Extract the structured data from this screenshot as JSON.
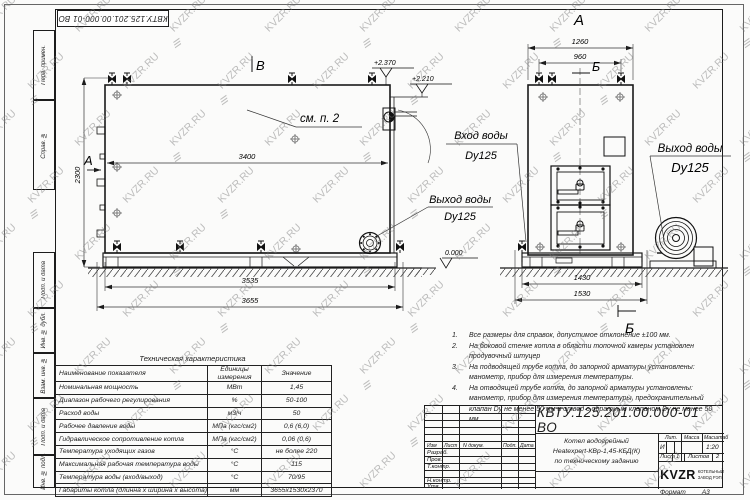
{
  "watermark": {
    "text": "KVZR.RU",
    "logo_glyph": "≡"
  },
  "stamp_top": "КВТУ.125.201.00.000-01 ВО",
  "margin_labels": [
    "Перв. примен.",
    "Справ. №",
    "Подп. и дата",
    "Инв. № дубл.",
    "Взам. инв. №",
    "Подп. и дата",
    "Инв. № подл."
  ],
  "side_view": {
    "label_top": "В",
    "label_left": "А",
    "see_note": "см. п. 2",
    "dim_inner": "3400",
    "dim_height": "2300",
    "dim_skid": "3535",
    "dim_total": "3655",
    "elev_top": "+2.370",
    "elev_step": "+2.210",
    "outlet_title": "Выход воды",
    "outlet_dn": "Dy125"
  },
  "front_view": {
    "label_top": "А",
    "label_section_top": "Б",
    "label_section_bottom": "Б",
    "dim_width": "1260",
    "dim_valves": "960",
    "dim_skid": "1430",
    "dim_total": "1530",
    "inlet_title": "Вход воды",
    "inlet_dn": "Dy125",
    "outlet_title": "Выход воды",
    "outlet_dn": "Dy125",
    "level_zero": "0.000"
  },
  "notes": [
    "Все размеры для справок, допустимое отклонение ±100 мм.",
    "На боковой стенке котла в области топочной камеры установлен продувочный штуцер",
    "На  подводящей трубе котла, до запорной арматуры установлены: манометр, прибор для измерения температуры.",
    "На отводящей трубе котла, до запорной арматуры установлены: манометр, прибор для измерения температуры, предохранительный клапан Dу не менее 50 мм и отвод с обратным клапаном Dу не менее 50 мм."
  ],
  "spec_table": {
    "title": "Техническая характеристика",
    "headers": [
      "Наименование показателя",
      "Единицы измерения",
      "Значение"
    ],
    "rows": [
      [
        "Номинальная мощность",
        "МВт",
        "1,45"
      ],
      [
        "Диапазон рабочего регулирования",
        "%",
        "50-100"
      ],
      [
        "Расход воды",
        "м3/ч",
        "50"
      ],
      [
        "Рабочее давление воды",
        "МПа (кгс/см2)",
        "0,6 (6,0)"
      ],
      [
        "Гидравлическое сопротивление котла",
        "МПа (кгс/см2)",
        "0,06 (0,6)"
      ],
      [
        "Температура уходящих газов",
        "°С",
        "не более 220"
      ],
      [
        "Максимальная рабочая температура воды",
        "°С",
        "115"
      ],
      [
        "Температура воды (вход/выход)",
        "°С",
        "70/95"
      ],
      [
        "Габариты котла (длинна х ширина х высота)",
        "мм",
        "3655х1530х2370"
      ]
    ]
  },
  "title_block": {
    "designation": "КВТУ.125.201.00.000-01 ВО",
    "product_name_1": "Котел водогрейный",
    "product_name_2": "Heatexpert-КВр-1,45-КБД(К)",
    "product_name_3": "по техническому заданию",
    "header_cols": [
      "Изм",
      "Лист",
      "N докум.",
      "Подп.",
      "Дата"
    ],
    "roles": [
      "Разраб.",
      "Пров.",
      "Т.контр.",
      "Н.контр.",
      "Утв."
    ],
    "lit_label": "Лит.",
    "lit_value": "И",
    "mass_label": "Масса",
    "scale_label": "Масштаб",
    "scale_value": "1:20",
    "sheet_label": "Лист",
    "sheet_value": "1",
    "sheets_label": "Листов",
    "sheets_value": "2",
    "company_logo": "KVZR",
    "company_line1": "КОТЕЛЬНЫЙ",
    "company_line2": "ЗАВОД РЭП",
    "format_label": "Формат",
    "format_value": "А3"
  }
}
